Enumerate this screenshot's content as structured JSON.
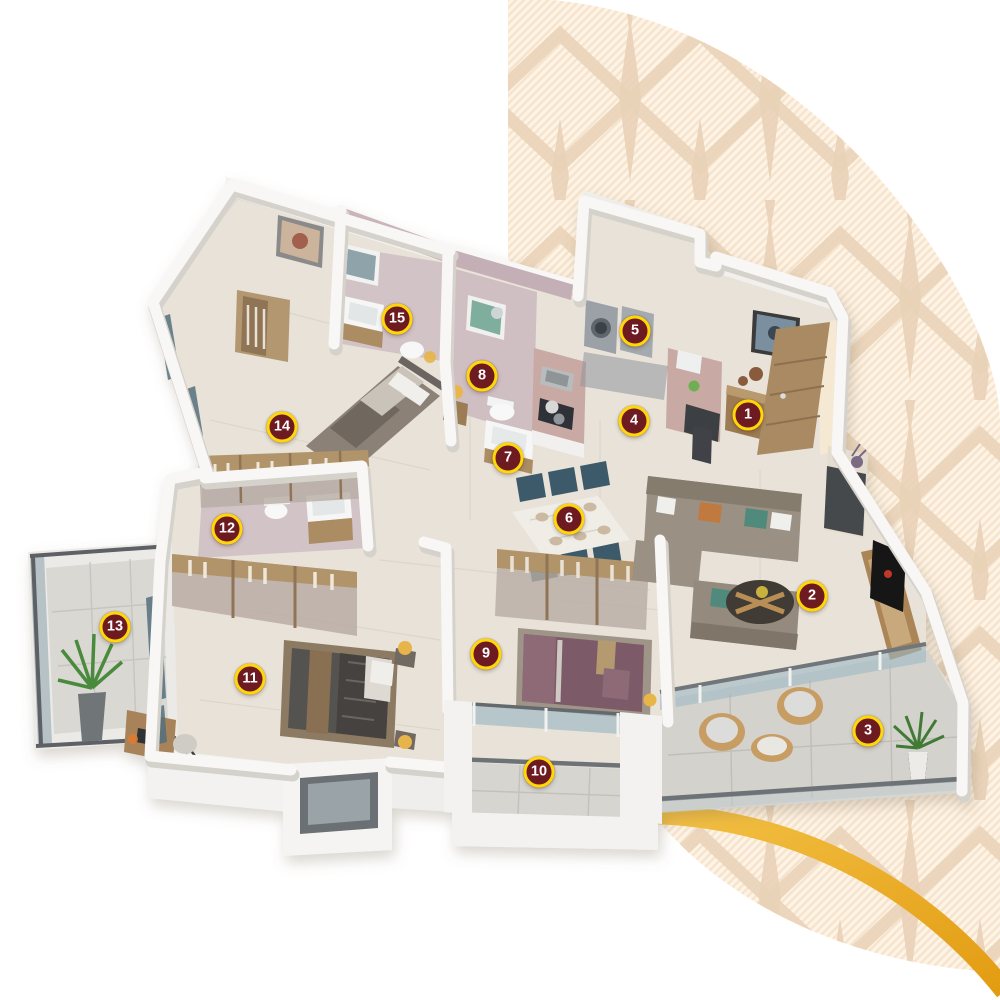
{
  "colors": {
    "marker_bg": "#6e1a21",
    "marker_ring": "#ffd608",
    "marker_text": "#ffffff",
    "gold1": "#f4c246",
    "gold2": "#e29c12",
    "stripe_l": "#fdf4e7",
    "stripe_d": "#f7e4cd",
    "motif": "#e9d2b7"
  },
  "markers": {
    "items": [
      {
        "label": "1",
        "x": 748,
        "y": 415
      },
      {
        "label": "2",
        "x": 812,
        "y": 596
      },
      {
        "label": "3",
        "x": 868,
        "y": 731
      },
      {
        "label": "4",
        "x": 634,
        "y": 421
      },
      {
        "label": "5",
        "x": 635,
        "y": 331
      },
      {
        "label": "6",
        "x": 569,
        "y": 519
      },
      {
        "label": "7",
        "x": 508,
        "y": 458
      },
      {
        "label": "8",
        "x": 482,
        "y": 376
      },
      {
        "label": "9",
        "x": 486,
        "y": 654
      },
      {
        "label": "10",
        "x": 539,
        "y": 772
      },
      {
        "label": "11",
        "x": 250,
        "y": 679
      },
      {
        "label": "12",
        "x": 227,
        "y": 529
      },
      {
        "label": "13",
        "x": 115,
        "y": 627
      },
      {
        "label": "14",
        "x": 282,
        "y": 427
      },
      {
        "label": "15",
        "x": 397,
        "y": 319
      }
    ]
  }
}
